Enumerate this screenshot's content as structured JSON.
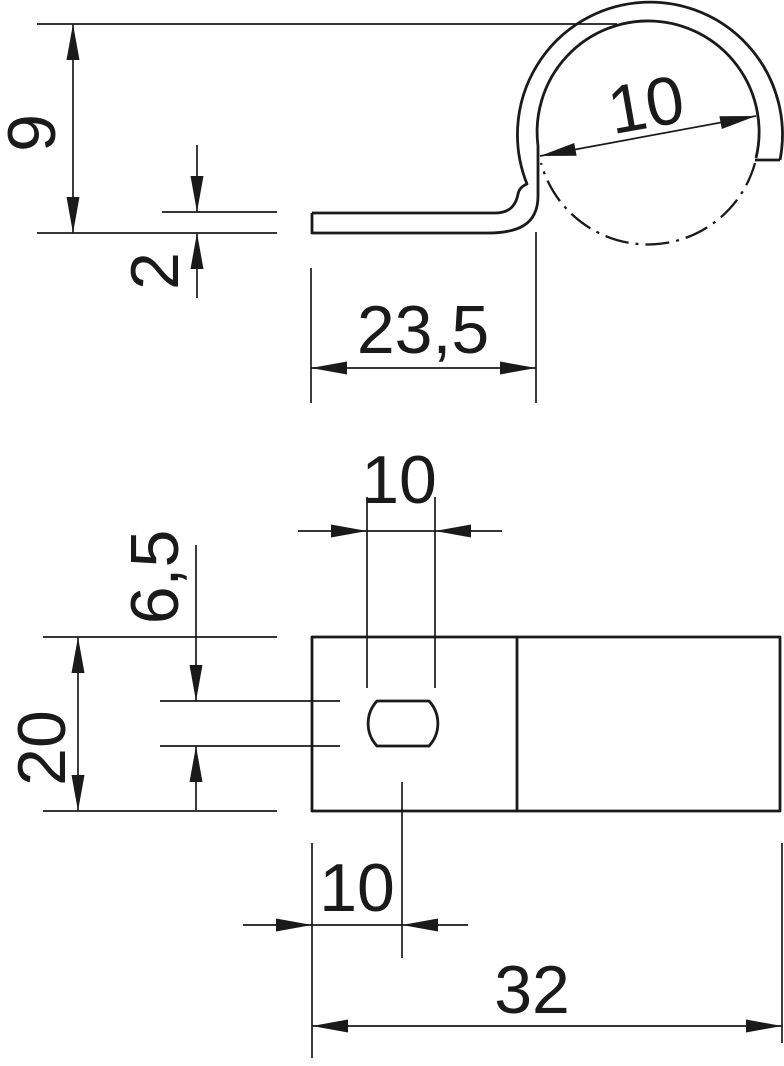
{
  "colors": {
    "line": "#1a1a1a",
    "background": "#ffffff"
  },
  "side_view": {
    "height": "9",
    "thickness": "2",
    "leg_length": "23,5",
    "loop_diameter": "10"
  },
  "plan_view": {
    "slot_length": "10",
    "slot_width": "6,5",
    "plate_width": "20",
    "slot_offset": "10",
    "plate_length": "32"
  }
}
